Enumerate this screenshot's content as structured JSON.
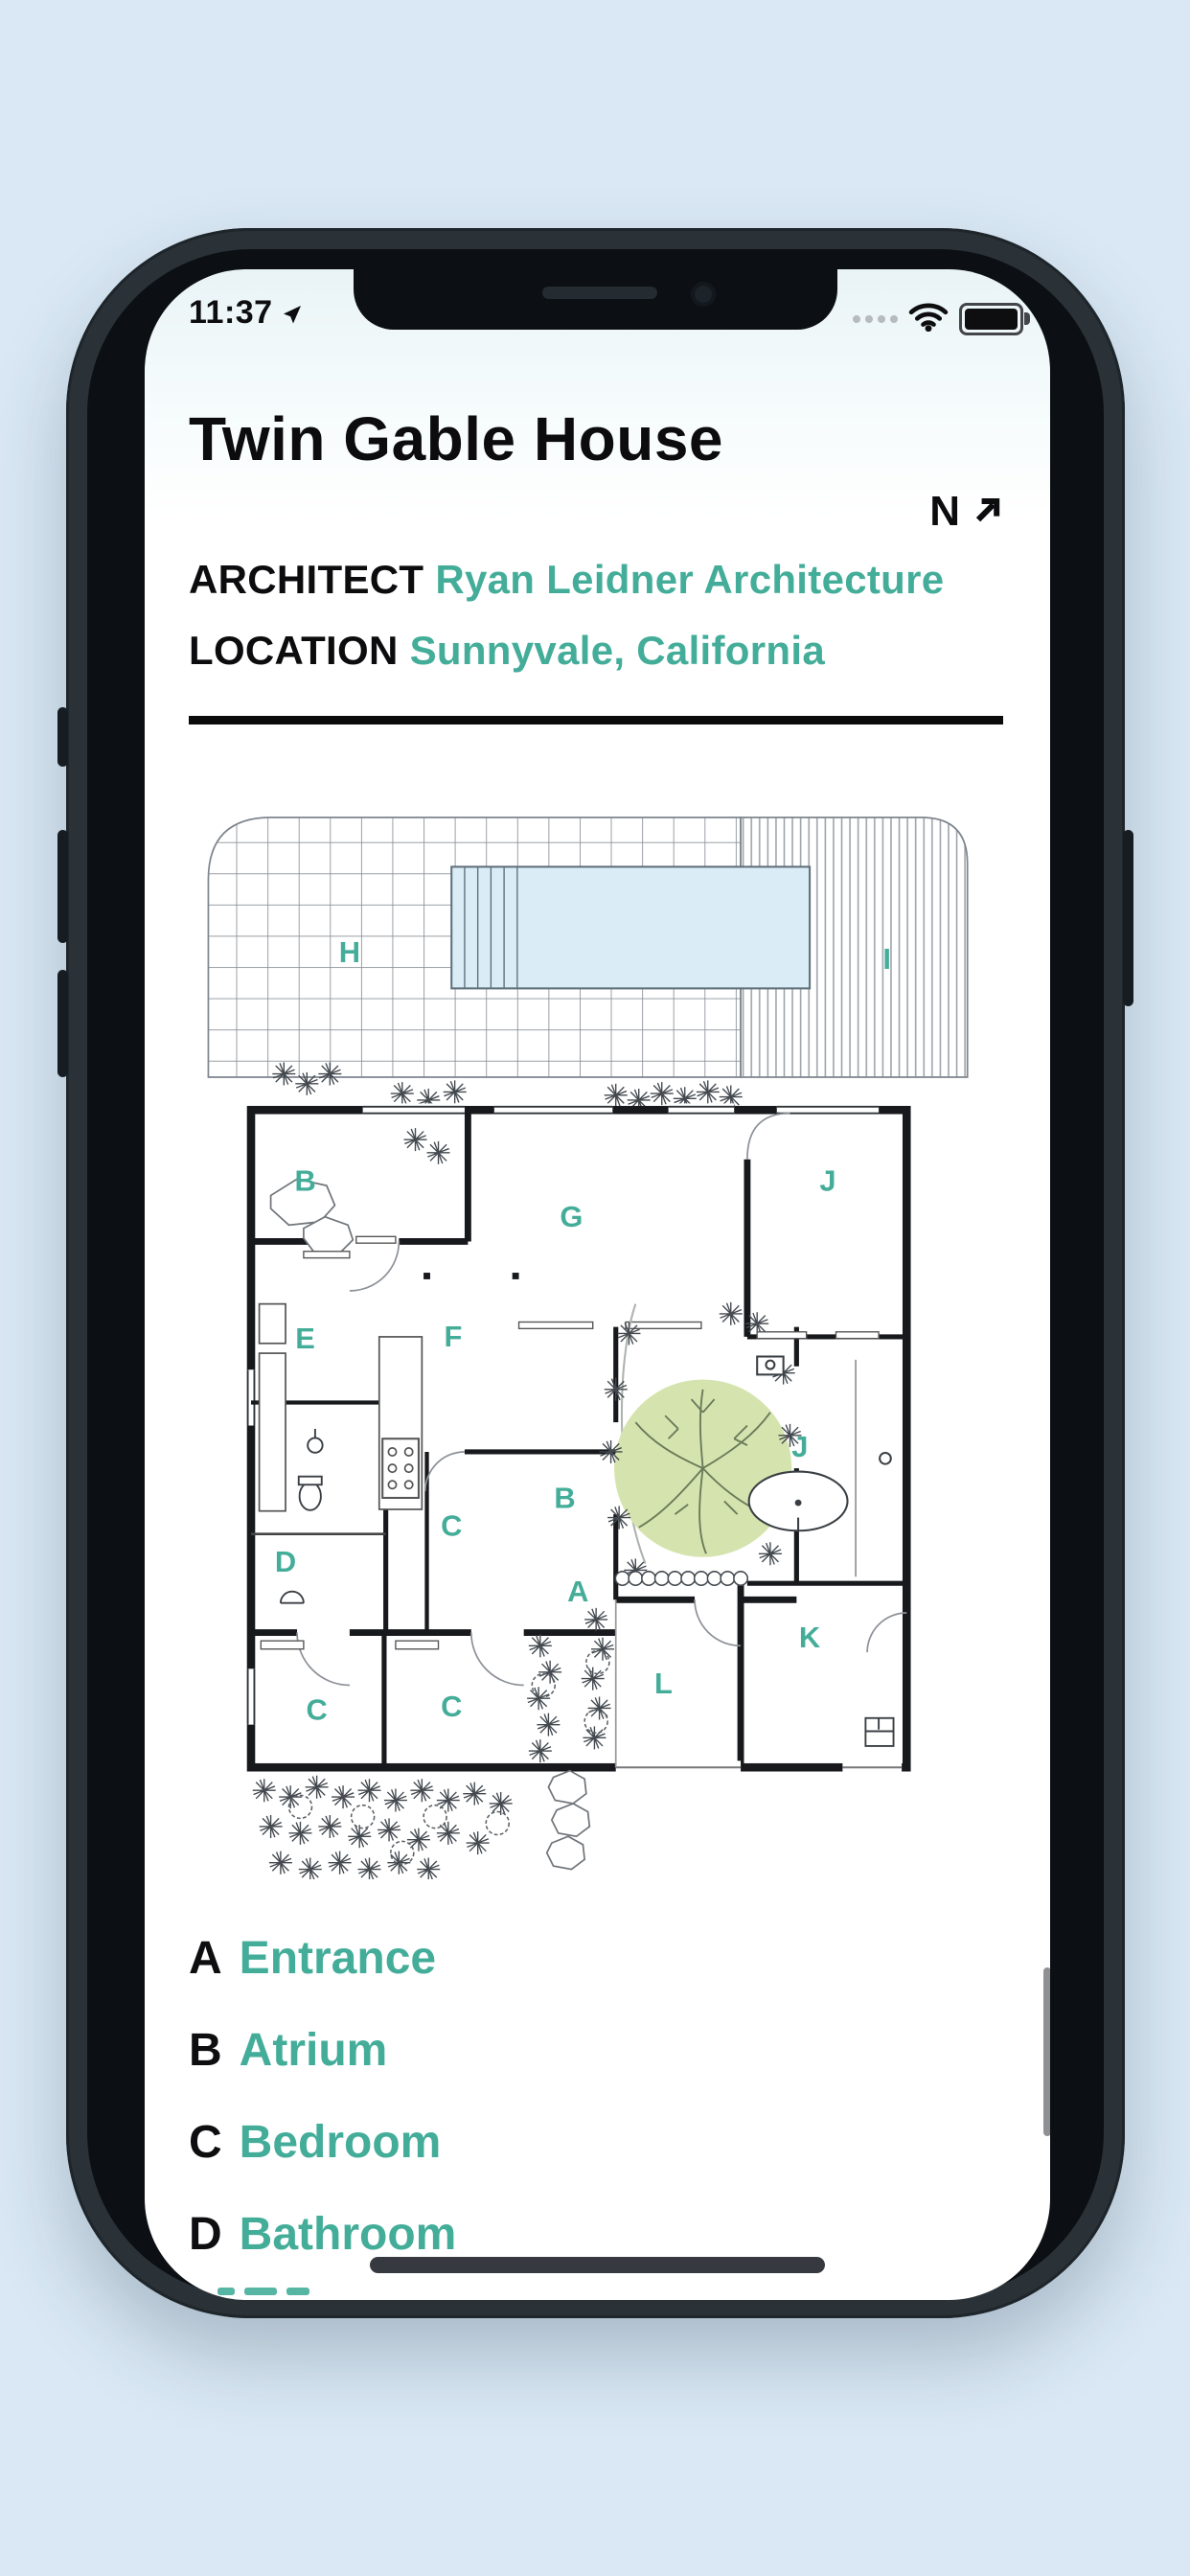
{
  "status_bar": {
    "time": "11:37",
    "location_icon": "nav-arrow",
    "signal_dots_count": "4",
    "wifi_icon": "wifi",
    "battery_icon": "battery-full"
  },
  "header": {
    "title": "Twin Gable House",
    "compass_letter": "N",
    "compass_icon": "north-east-arrow"
  },
  "meta": {
    "architect_label": "ARCHITECT",
    "architect_value": "Ryan Leidner Architecture",
    "location_label": "LOCATION",
    "location_value": "Sunnyvale, California"
  },
  "plan": {
    "labels": [
      {
        "char": "H"
      },
      {
        "char": "I"
      },
      {
        "char": "B"
      },
      {
        "char": "G"
      },
      {
        "char": "J"
      },
      {
        "char": "E"
      },
      {
        "char": "F"
      },
      {
        "char": "B"
      },
      {
        "char": "J"
      },
      {
        "char": "C"
      },
      {
        "char": "D"
      },
      {
        "char": "A"
      },
      {
        "char": "C"
      },
      {
        "char": "C"
      },
      {
        "char": "L"
      },
      {
        "char": "K"
      }
    ]
  },
  "legend": {
    "items": [
      {
        "letter": "A",
        "name": "Entrance"
      },
      {
        "letter": "B",
        "name": "Atrium"
      },
      {
        "letter": "C",
        "name": "Bedroom"
      },
      {
        "letter": "D",
        "name": "Bathroom"
      }
    ],
    "next_item_partially_visible": true
  },
  "colors": {
    "accent": "#44ad99",
    "pool_fill": "#daecf5",
    "tree_fill": "#d5e4af",
    "wall": "#17191c",
    "page_background": "#d9e8f4"
  }
}
